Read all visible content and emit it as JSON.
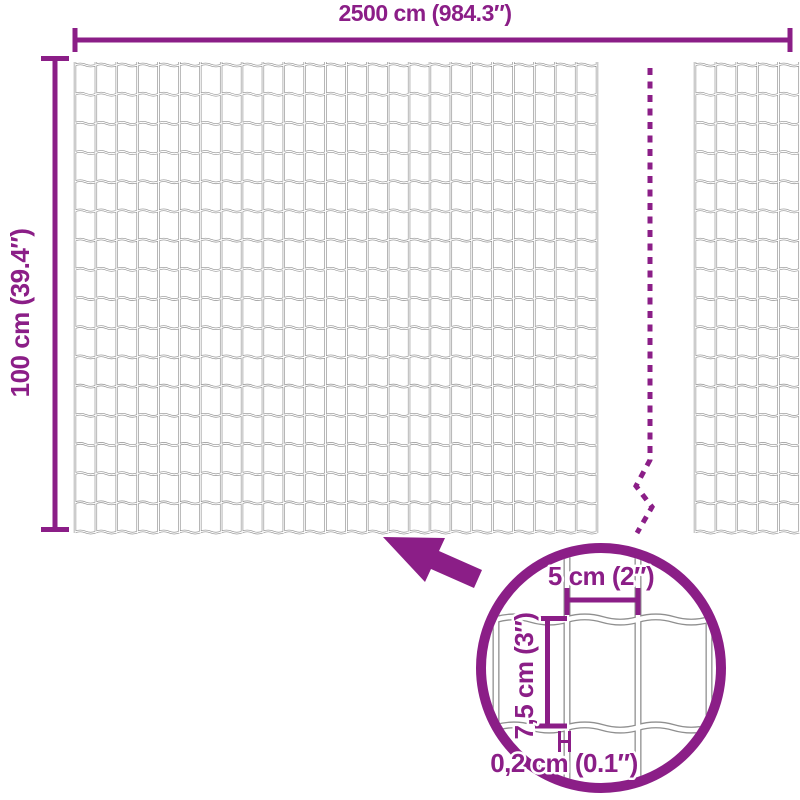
{
  "diagram": {
    "kind": "wire-mesh-fence-dimension-diagram",
    "labels": {
      "total_width": "2500 cm (984.3″)",
      "total_height": "100 cm (39.4″)",
      "cell_width": "5 cm (2″)",
      "cell_height": "7,5 cm (3″)",
      "wire_thickness": "0,2 cm (0.1″)"
    },
    "colors": {
      "accent": "#8B1E87",
      "wire": "#8F8F8F",
      "background": "#FFFFFF"
    }
  }
}
